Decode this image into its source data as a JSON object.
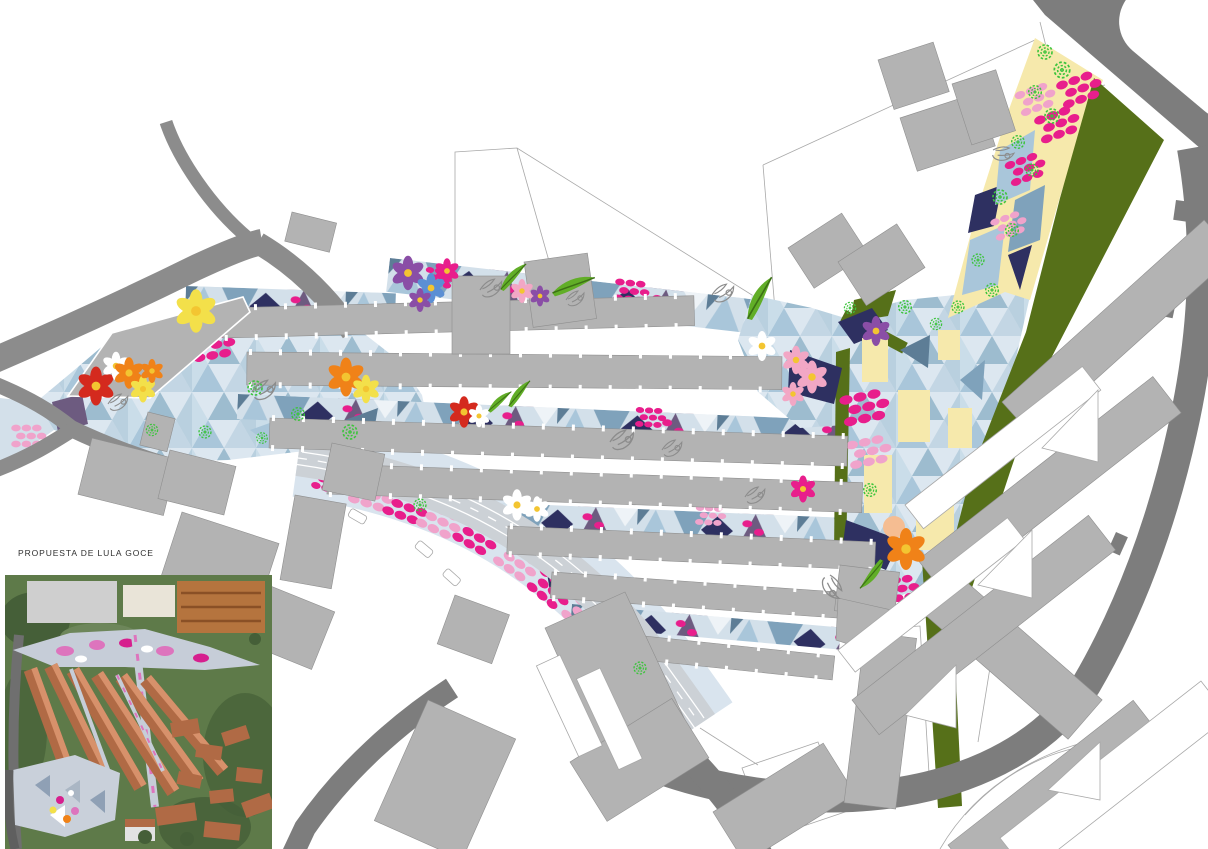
{
  "inset": {
    "caption": "PROPUESTA DE LULA GOCE"
  },
  "colors": {
    "road": "#8c8c8c",
    "road_dark": "#7d7d7d",
    "street": "#ccd1d6",
    "flank": "#d9e4ee",
    "building": "#b3b3b3",
    "building_edge": "#8f8f8f",
    "parcel_line": "#a8a8a8",
    "pale_blue": "#d3e0ea",
    "mid_blue": "#a9c6da",
    "steel_blue": "#7fa2bb",
    "slate_blue": "#5d7d96",
    "navy": "#2e3061",
    "purple": "#6d5b80",
    "mauve": "#9c82a4",
    "magenta": "#e81e8c",
    "soft_pink": "#f0a3cb",
    "cream": "#f6e9ac",
    "olive": "#567019",
    "tree_green": "#3cc43c",
    "leaf_green": "#61ae27",
    "sketch_gray": "#8c8c8c",
    "flower_red": "#d42a1e",
    "flower_orange": "#f08218",
    "flower_yellow": "#f3e04a",
    "flower_white": "#ffffff",
    "flower_pink": "#f2a7c5",
    "flower_blue": "#5b8fd4",
    "flower_violet": "#8a4ea6",
    "flower_center": "#f3c531",
    "photo_green": "#5e7a49",
    "photo_green_dark": "#455f38",
    "photo_roof": "#b06a45",
    "photo_roof_light": "#d7916b",
    "photo_road": "#6f6f6f",
    "photo_paving": "#c6cdd8",
    "photo_pink": "#dd74bd",
    "photo_brick": "#b5743e",
    "photo_cream": "#e9e4d8"
  }
}
